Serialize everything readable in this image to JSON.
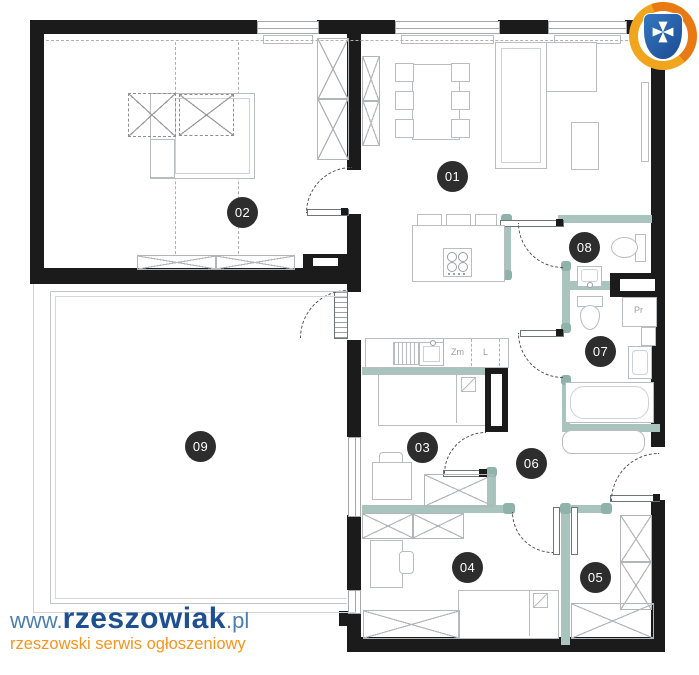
{
  "branding": {
    "url_prefix": "www.",
    "site_name": "rzeszowiak",
    "url_suffix": ".pl",
    "tagline": "rzeszowski serwis ogłoszeniowy",
    "colors": {
      "prefix_blue": "#4d7fae",
      "name_navy": "#1e4f90",
      "tagline_orange": "#f7941e"
    }
  },
  "plan": {
    "rooms": [
      {
        "id": "01",
        "label": "01"
      },
      {
        "id": "02",
        "label": "02"
      },
      {
        "id": "03",
        "label": "03"
      },
      {
        "id": "04",
        "label": "04"
      },
      {
        "id": "05",
        "label": "05"
      },
      {
        "id": "06",
        "label": "06"
      },
      {
        "id": "07",
        "label": "07"
      },
      {
        "id": "08",
        "label": "08"
      },
      {
        "id": "09",
        "label": "09"
      }
    ],
    "appliances": {
      "dishwasher": "Zm",
      "fridge": "L",
      "washer": "Pr"
    },
    "colors": {
      "wall": "#1b1b1b",
      "partition_teal": "#a9c4bd",
      "partition_teal_dark": "#8fb2aa",
      "furniture_line": "#b9bdbf",
      "label_bg": "#2d2d2d",
      "label_text": "#ffffff"
    }
  }
}
